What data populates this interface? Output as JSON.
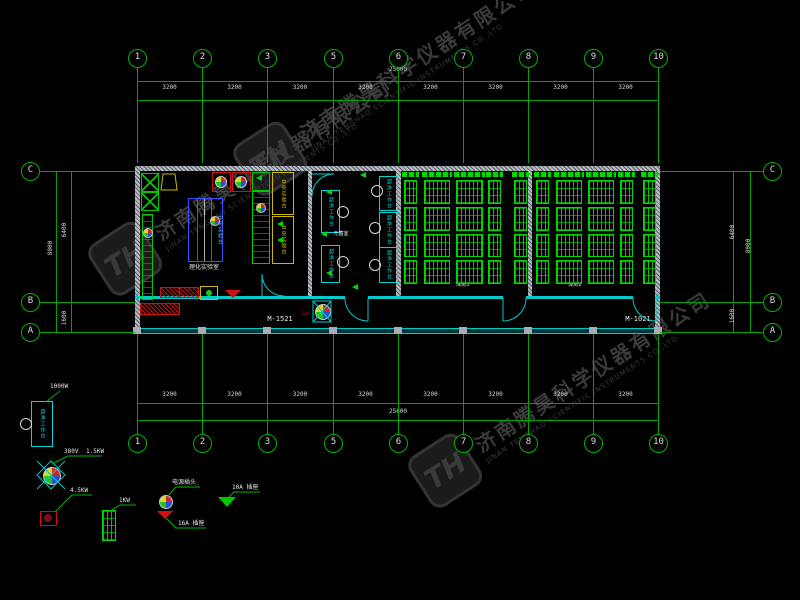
{
  "watermark": {
    "logo_text": "TH",
    "company_cn": "济南腾昊科学仪器有限公司",
    "company_en": "JINAN TENGHAO SCIENTIFIC INSTRUMENTS CO.,LTD"
  },
  "grid": {
    "column_labels": [
      "1",
      "2",
      "3",
      "5",
      "6",
      "7",
      "8",
      "9",
      "10"
    ],
    "row_labels": [
      "C",
      "B",
      "A"
    ],
    "top": {
      "total": "25600",
      "segments": [
        "3200",
        "3200",
        "3200",
        "3200",
        "3200",
        "3200",
        "3200",
        "3200"
      ]
    },
    "bottom": {
      "total": "25600",
      "segments": [
        "3200",
        "3200",
        "3200",
        "3200",
        "3200",
        "3200",
        "3200",
        "3200"
      ]
    },
    "left": {
      "total": "8000",
      "segments": [
        "6400",
        "1600"
      ]
    },
    "right": {
      "total": "8000",
      "segments": [
        "6400",
        "1600"
      ]
    }
  },
  "rooms": {
    "lab": {
      "label": "理化实验室",
      "central_bench_blue": "中央实验台",
      "central_bench_yellow": "中央实验台"
    },
    "sterile": {
      "label": "无菌室",
      "clean_bench": "超净工作台"
    },
    "storage1": {
      "label": "库房1"
    },
    "storage2": {
      "label": "库房2"
    }
  },
  "doors": {
    "left": "M-1521",
    "right": "M-1021"
  },
  "corridor": {
    "fan_label": "风机"
  },
  "legend": {
    "clean_bench": {
      "label": "超净工作台",
      "power": "1000W"
    },
    "fan_unit": {
      "voltage": "380V",
      "power": "1.5KW"
    },
    "heater": {
      "power": "4.5KW"
    },
    "oven": {
      "power": "1KW"
    },
    "plug": {
      "label": "电源插头"
    },
    "socket_16a": {
      "label": "16A 插座"
    },
    "socket_10a": {
      "label": "10A 插座"
    }
  },
  "colors": {
    "background": "#000000",
    "grid_green": "#00a400",
    "cad_cyan": "#00caca",
    "rack_green": "#00d800",
    "dim_text": "#d8d8d8",
    "alert_red": "#d01010",
    "bench_yellow": "#cdb800",
    "bench_blue": "#3c50ff",
    "watermark_grey": "#3a3a3a"
  }
}
